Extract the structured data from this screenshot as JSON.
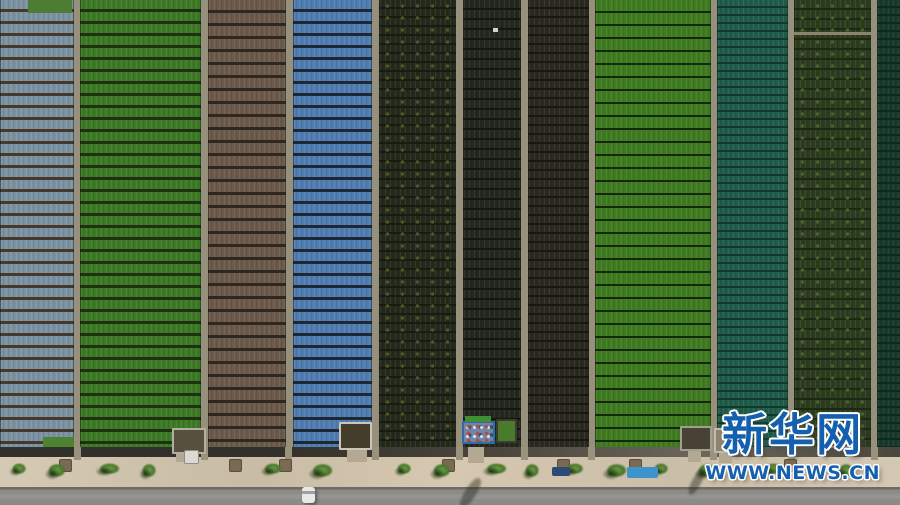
{
  "watermark": {
    "site_name": "新华网",
    "site_url": "WWW.NEWS.CN",
    "text_color": "#1460ae",
    "outline_color": "#ffffff"
  },
  "scene": {
    "path_color": "#97907c",
    "fields_height": 447,
    "strips": [
      {
        "name": "blue-gray-mulch",
        "x": 0,
        "w": 74,
        "base": "#7b92a3",
        "line": "#46392c",
        "pitch": 12,
        "line_w": 3
      },
      {
        "name": "green-crop",
        "x": 80,
        "w": 121,
        "base": "#3d7a26",
        "line": "#1e3110",
        "pitch": 12,
        "line_w": 3
      },
      {
        "name": "brown-soil",
        "x": 208,
        "w": 78,
        "base": "#6b5a4a",
        "line": "#2f2820",
        "pitch": 13,
        "line_w": 3
      },
      {
        "name": "blue-mulch",
        "x": 293,
        "w": 79,
        "base": "#4f7db2",
        "line": "#1d2834",
        "pitch": 12,
        "line_w": 3
      },
      {
        "name": "dark-crop-1",
        "x": 379,
        "w": 77,
        "base": "#232a1b",
        "line": "#161c0f",
        "pitch": 9,
        "line_w": 2,
        "speckle": "#4c5c26"
      },
      {
        "name": "dark-crop-2",
        "x": 463,
        "w": 58,
        "base": "#24271e",
        "line": "#14170f",
        "pitch": 10,
        "line_w": 2
      },
      {
        "name": "dark-soil",
        "x": 528,
        "w": 61,
        "base": "#2a2921",
        "line": "#181811",
        "pitch": 9,
        "line_w": 2
      },
      {
        "name": "bright-green",
        "x": 595,
        "w": 116,
        "base": "#3f7b20",
        "line": "#15280a",
        "pitch": 13,
        "line_w": 2
      },
      {
        "name": "teal-crop",
        "x": 717,
        "w": 71,
        "base": "#1f5d4a",
        "line": "#0f3a2d",
        "pitch": 8,
        "line_w": 2
      },
      {
        "name": "olive-crop",
        "x": 794,
        "w": 77,
        "base": "#2c3c1e",
        "line": "#1c2813",
        "pitch": 10,
        "line_w": 2,
        "speckle": "#4d6429"
      },
      {
        "name": "dark-teal-crop",
        "x": 877,
        "w": 23,
        "base": "#17392c",
        "line": "#0c2a1f",
        "pitch": 8,
        "line_w": 2
      }
    ],
    "top_patch": {
      "x": 28,
      "y": 0,
      "w": 44,
      "h": 13,
      "color": "#4d7c33"
    },
    "bottom_patch": {
      "x": 43,
      "y": 437,
      "w": 31,
      "h": 10,
      "color": "#4d8230"
    },
    "cross_line": {
      "x": 794,
      "y": 32,
      "w": 77,
      "h": 3,
      "color": "#8a8468"
    },
    "white_dot": {
      "x": 493,
      "y": 28,
      "w": 5,
      "h": 4,
      "color": "#ccd4d8"
    },
    "ditch": {
      "y": 447,
      "h": 10,
      "colors": [
        "#32302a",
        "#4a463c",
        "#6b675d"
      ]
    },
    "sidewalk": {
      "y": 457,
      "h": 30,
      "color": "#cfc2aa"
    },
    "road": {
      "y": 487,
      "h": 18,
      "color": "#8d8b87",
      "edge": "#6e6b66",
      "center": "#97948f"
    },
    "divider_stubs": {
      "xs": [
        77,
        204,
        288,
        375,
        459,
        524,
        591,
        713,
        791,
        874
      ],
      "y": 447,
      "w": 7,
      "h": 13,
      "color": "#9b927e"
    },
    "aprons": [
      {
        "x": 176,
        "y": 452,
        "w": 18,
        "h": 10
      },
      {
        "x": 347,
        "y": 450,
        "w": 20,
        "h": 12
      },
      {
        "x": 468,
        "y": 447,
        "w": 16,
        "h": 16
      },
      {
        "x": 688,
        "y": 450,
        "w": 13,
        "h": 12
      },
      {
        "x": 719,
        "y": 452,
        "w": 13,
        "h": 11
      }
    ],
    "apron_color": "#b3a993",
    "trees": {
      "xs": [
        18,
        55,
        108,
        148,
        271,
        321,
        403,
        440,
        495,
        531,
        573,
        615,
        660,
        705,
        772,
        845
      ],
      "y": 461,
      "light": "#6a9645",
      "mid": "#47762a",
      "shade": "#1e3510"
    },
    "pits": {
      "xs": [
        65,
        235,
        285,
        448,
        563,
        635,
        790
      ],
      "y": 459,
      "size": 13,
      "color": "#7a6a52"
    },
    "sheds": [
      {
        "x": 172,
        "y": 428,
        "w": 34,
        "h": 26,
        "frame": "#b5ada0",
        "fill": "#56503f"
      },
      {
        "x": 339,
        "y": 422,
        "w": 33,
        "h": 28,
        "frame": "#ccc6b9",
        "fill": "#453d2c"
      },
      {
        "x": 462,
        "y": 421,
        "w": 33,
        "h": 23,
        "frame": "#2f6ba5",
        "fill": "#6f86a4",
        "colorful": true
      },
      {
        "x": 496,
        "y": 419,
        "w": 21,
        "h": 24,
        "frame": "#3c3c2c",
        "fill": "#4a7a2e"
      },
      {
        "x": 680,
        "y": 426,
        "w": 32,
        "h": 25,
        "frame": "#a49e90",
        "fill": "#474233"
      },
      {
        "x": 714,
        "y": 428,
        "w": 24,
        "h": 25,
        "frame": "#c2baa9",
        "fill": "#8b8270"
      },
      {
        "x": 828,
        "y": 425,
        "w": 32,
        "h": 23,
        "frame": "#9b9585",
        "fill": "#3e3b2f"
      }
    ],
    "green_bar": {
      "x": 465,
      "y": 416,
      "w": 26,
      "h": 6,
      "color": "#3f9035"
    },
    "tarps": [
      {
        "x": 627,
        "y": 467,
        "w": 31,
        "h": 11,
        "color": "#3d93cc"
      },
      {
        "x": 552,
        "y": 467,
        "w": 18,
        "h": 9,
        "color": "#2b4a78"
      }
    ],
    "road_vehicle": {
      "x": 302,
      "y": 487,
      "w": 13,
      "h": 16,
      "body": "#e9e8e4",
      "glass": "#9aa0a4"
    },
    "parked_vehicle": {
      "x": 184,
      "y": 450,
      "w": 15,
      "h": 14,
      "color": "#dcdad2"
    },
    "shadows": [
      {
        "x": 465,
        "y": 476,
        "w": 11,
        "h": 34,
        "rot": 32
      },
      {
        "x": 692,
        "y": 468,
        "w": 9,
        "h": 28,
        "rot": 28
      }
    ]
  }
}
